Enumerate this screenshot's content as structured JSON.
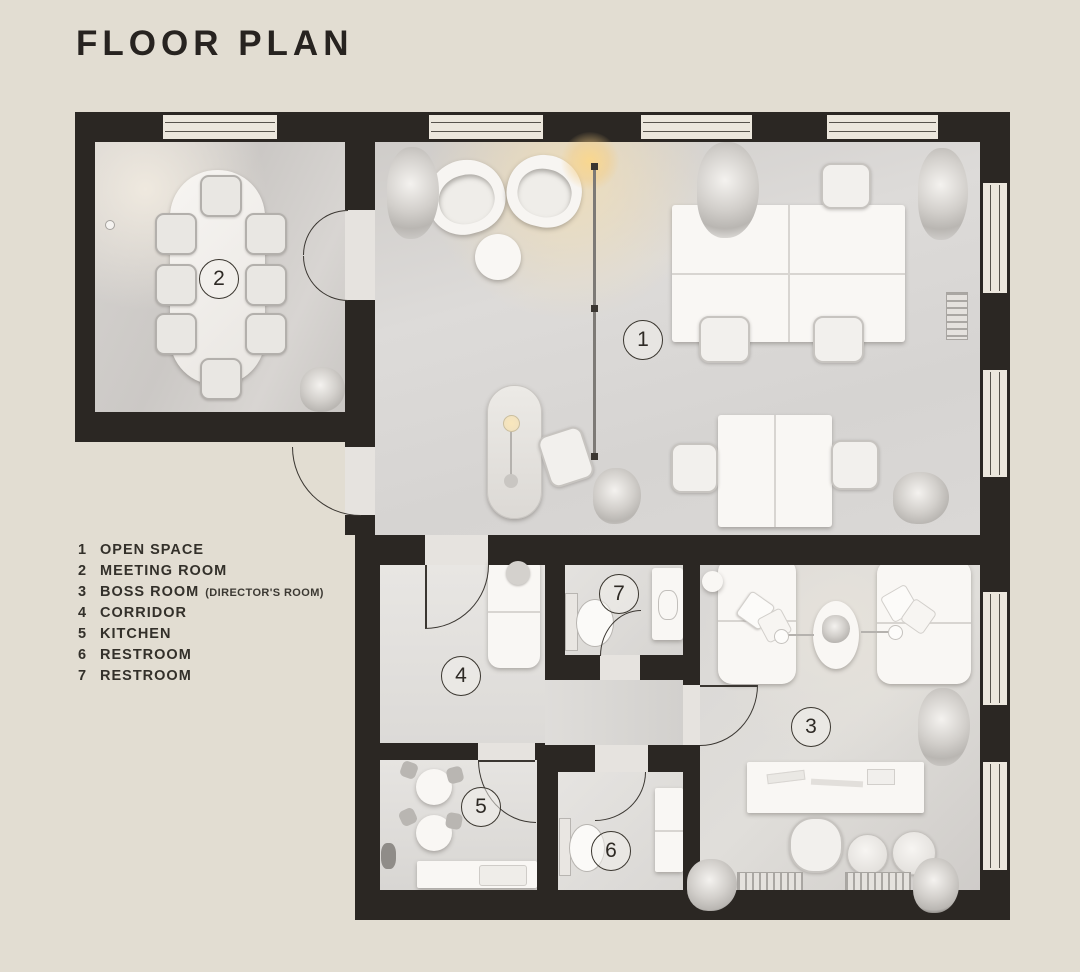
{
  "title": "FLOOR PLAN",
  "legend": {
    "items": [
      {
        "num": "1",
        "label": "OPEN SPACE",
        "note": ""
      },
      {
        "num": "2",
        "label": "MEETING ROOM",
        "note": ""
      },
      {
        "num": "3",
        "label": "BOSS ROOM",
        "note": "(DIRECTOR'S ROOM)"
      },
      {
        "num": "4",
        "label": "CORRIDOR",
        "note": ""
      },
      {
        "num": "5",
        "label": "KITCHEN",
        "note": ""
      },
      {
        "num": "6",
        "label": "RESTROOM",
        "note": ""
      },
      {
        "num": "7",
        "label": "RESTROOM",
        "note": ""
      }
    ]
  },
  "rooms": {
    "open_space": {
      "number": "1"
    },
    "meeting_room": {
      "number": "2"
    },
    "boss_room": {
      "number": "3"
    },
    "corridor": {
      "number": "4"
    },
    "kitchen": {
      "number": "5"
    },
    "restroom6": {
      "number": "6"
    },
    "restroom7": {
      "number": "7"
    }
  },
  "colors": {
    "background": "#e2ddd2",
    "wall": "#2b2723",
    "floor": "#d9d7d5",
    "window": "#ece7dd",
    "lamp_glow": "#f3cf8e"
  }
}
